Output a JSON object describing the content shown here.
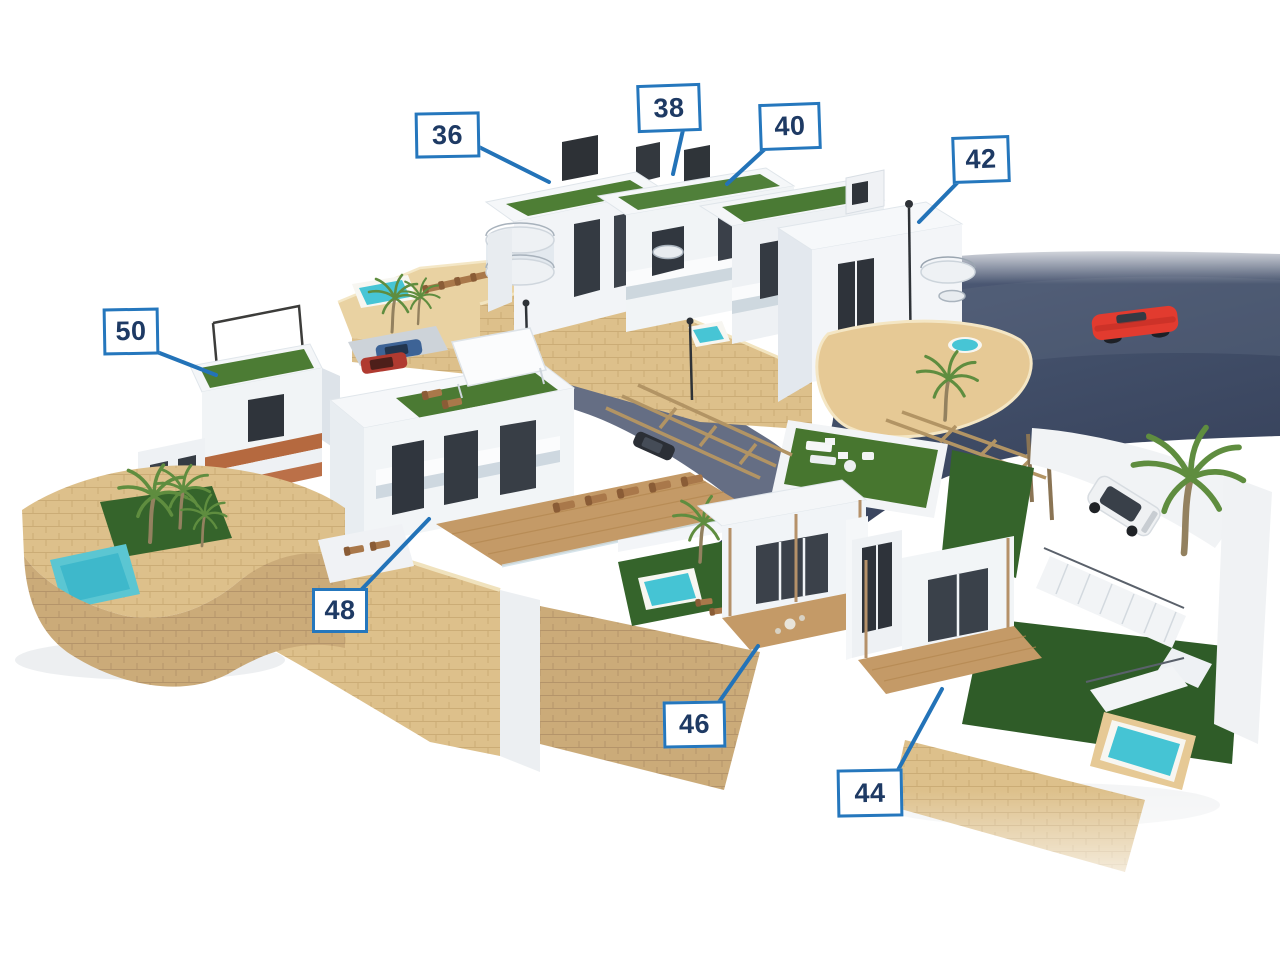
{
  "scene": {
    "type": "3d-architectural-aerial-rendering",
    "description": "Aerial 3D render of a hillside residential development: white modern villas and townhouses with green roof terraces, private pools, palm trees, sandstone retaining walls, timber pergolas, a curved asphalt road with a red convertible and a white SUV on a driveway.",
    "background_color": "#ffffff"
  },
  "annotation_style": {
    "box_fill": "#ffffff",
    "box_border_color": "#2577bd",
    "text_color": "#1e3a64",
    "leader_line_color": "#2373b8"
  },
  "unit_labels": [
    {
      "text": "36"
    },
    {
      "text": "38"
    },
    {
      "text": "40"
    },
    {
      "text": "42"
    },
    {
      "text": "50"
    },
    {
      "text": "48"
    },
    {
      "text": "46"
    },
    {
      "text": "44"
    }
  ],
  "scene_colors": {
    "white_walls": "#f3f5f8",
    "sandstone": "#ddc08b",
    "roof_turf": "#4e7e35",
    "lawn": "#35642b",
    "pool_water": "#47c5d5",
    "asphalt_road": "#43506a",
    "wood_deck": "#c49a67",
    "red_car": "#e23b2f",
    "white_suv": "#eff1f3",
    "palm_frond": "#5f8d3f"
  }
}
